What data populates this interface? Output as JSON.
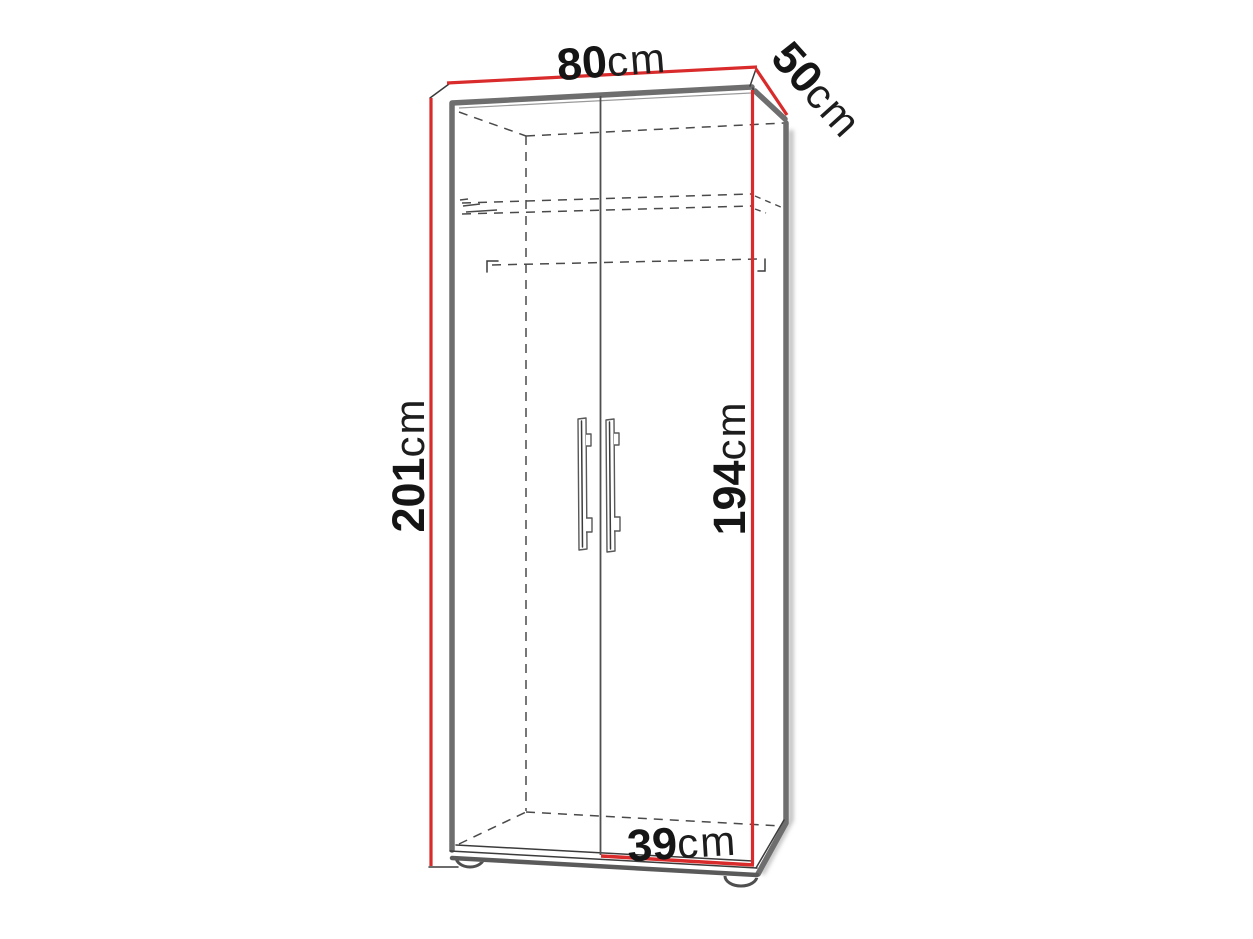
{
  "labels": {
    "width": {
      "value": "80",
      "unit": "cm"
    },
    "depth": {
      "value": "50",
      "unit": "cm"
    },
    "height": {
      "value": "201",
      "unit": "cm"
    },
    "door_height": {
      "value": "194",
      "unit": "cm"
    },
    "door_width": {
      "value": "39",
      "unit": "cm"
    }
  },
  "colors": {
    "dimension_line": "#d92b2b",
    "cabinet_edge": "#6e6e6e",
    "outline": "#3b3b3b",
    "hidden_line": "#4a4a4a",
    "label_text": "#151515",
    "background": "#ffffff"
  }
}
